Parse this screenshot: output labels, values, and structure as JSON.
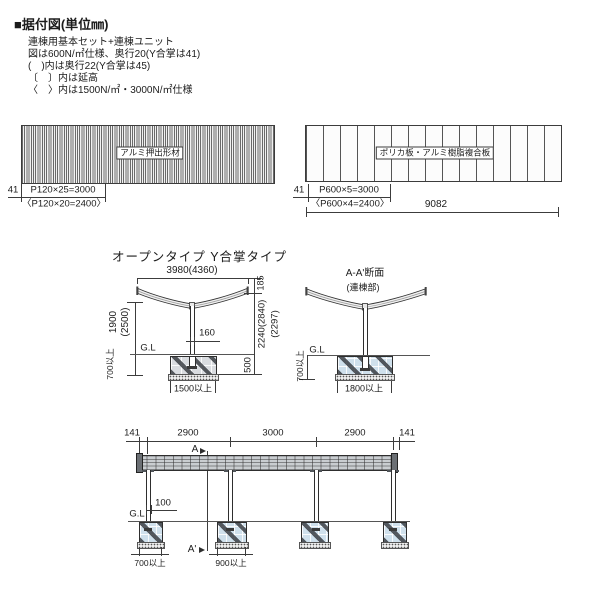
{
  "header": {
    "title": "■据付図(単位㎜)",
    "notes": [
      "連棟用基本セット+連棟ユニット",
      "図は600N/㎡仕様、奥行20(Y合掌は41)",
      "(　)内は奥行22(Y合掌は45)",
      "〔　〕内は延高",
      "〈　〉内は1500N/㎡・3000N/㎡仕様"
    ]
  },
  "roof_panels": {
    "left": {
      "material_label": "アルミ押出形材",
      "edge_dim": "41",
      "pitch_dim": "P120×25=3000",
      "pitch_dim_alt": "〈P120×20=2400〉"
    },
    "right": {
      "material_label": "ポリカ板・アルミ樹脂複合板",
      "edge_dim": "41",
      "pitch_dim": "P600×5=3000",
      "pitch_dim_alt": "〈P600×4=2400〉",
      "total_length": "9082"
    }
  },
  "elevations": {
    "section_title": "オープンタイプ Y合掌タイプ",
    "front": {
      "width_dim": "3980(4360)",
      "roof_rise_dim": "185",
      "height_dim": "1900",
      "height_dim_alt": "(2500)",
      "post_width_dim": "160",
      "clearance_dim": "2240(2840)",
      "clearance_dim_alt": "(2297)",
      "embed_dim": "700以上",
      "footing_depth_dim": "500",
      "ground_label": "G.L",
      "footing_width_dim": "1500以上"
    },
    "section": {
      "title": "A-A'断面",
      "subtitle": "(連棟部)",
      "ground_label": "G.L",
      "embed_dim": "700以上",
      "footing_width_dim": "1800以上"
    }
  },
  "side_view": {
    "top_dims": [
      "141",
      "2900",
      "3000",
      "2900",
      "141"
    ],
    "section_mark_start": "A",
    "section_mark_end": "A'",
    "post_width_dim": "100",
    "ground_label": "G.L",
    "footing_dim_1": "700以上",
    "footing_dim_2": "900以上"
  },
  "colors": {
    "line": "#3c3c3c",
    "concrete_blue": "#cfe0ec",
    "concrete_grey": "#d9dce0"
  }
}
